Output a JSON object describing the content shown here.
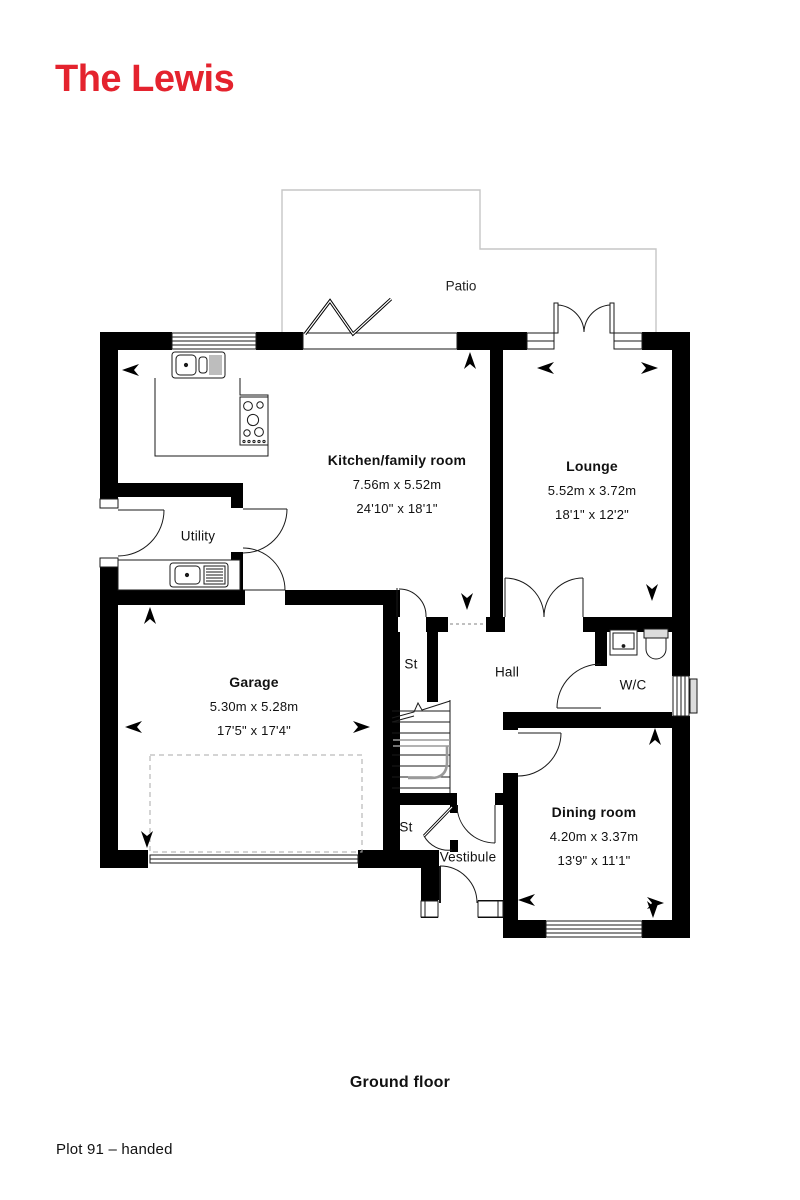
{
  "page": {
    "title": "The Lewis",
    "floor_caption": "Ground floor",
    "plot_caption": "Plot 91 – handed"
  },
  "colors": {
    "accent_red": "#e4232e",
    "wall_black": "#000000",
    "patio_gray": "#c6c6c6"
  },
  "plan": {
    "patio": {
      "label": "Patio"
    },
    "rooms": [
      {
        "name": "Kitchen/family room",
        "metric": "7.56m x 5.52m",
        "imperial": "24'10\" x 18'1\""
      },
      {
        "name": "Lounge",
        "metric": "5.52m x 3.72m",
        "imperial": "18'1\" x 12'2\""
      },
      {
        "name": "Garage",
        "metric": "5.30m x 5.28m",
        "imperial": "17'5\" x 17'4\""
      },
      {
        "name": "Dining room",
        "metric": "4.20m x 3.37m",
        "imperial": "13'9\" x 11'1\""
      },
      {
        "name": "Utility"
      },
      {
        "name": "Hall"
      },
      {
        "name": "W/C"
      },
      {
        "name": "St"
      },
      {
        "name": "St"
      },
      {
        "name": "Vestibule"
      }
    ]
  }
}
